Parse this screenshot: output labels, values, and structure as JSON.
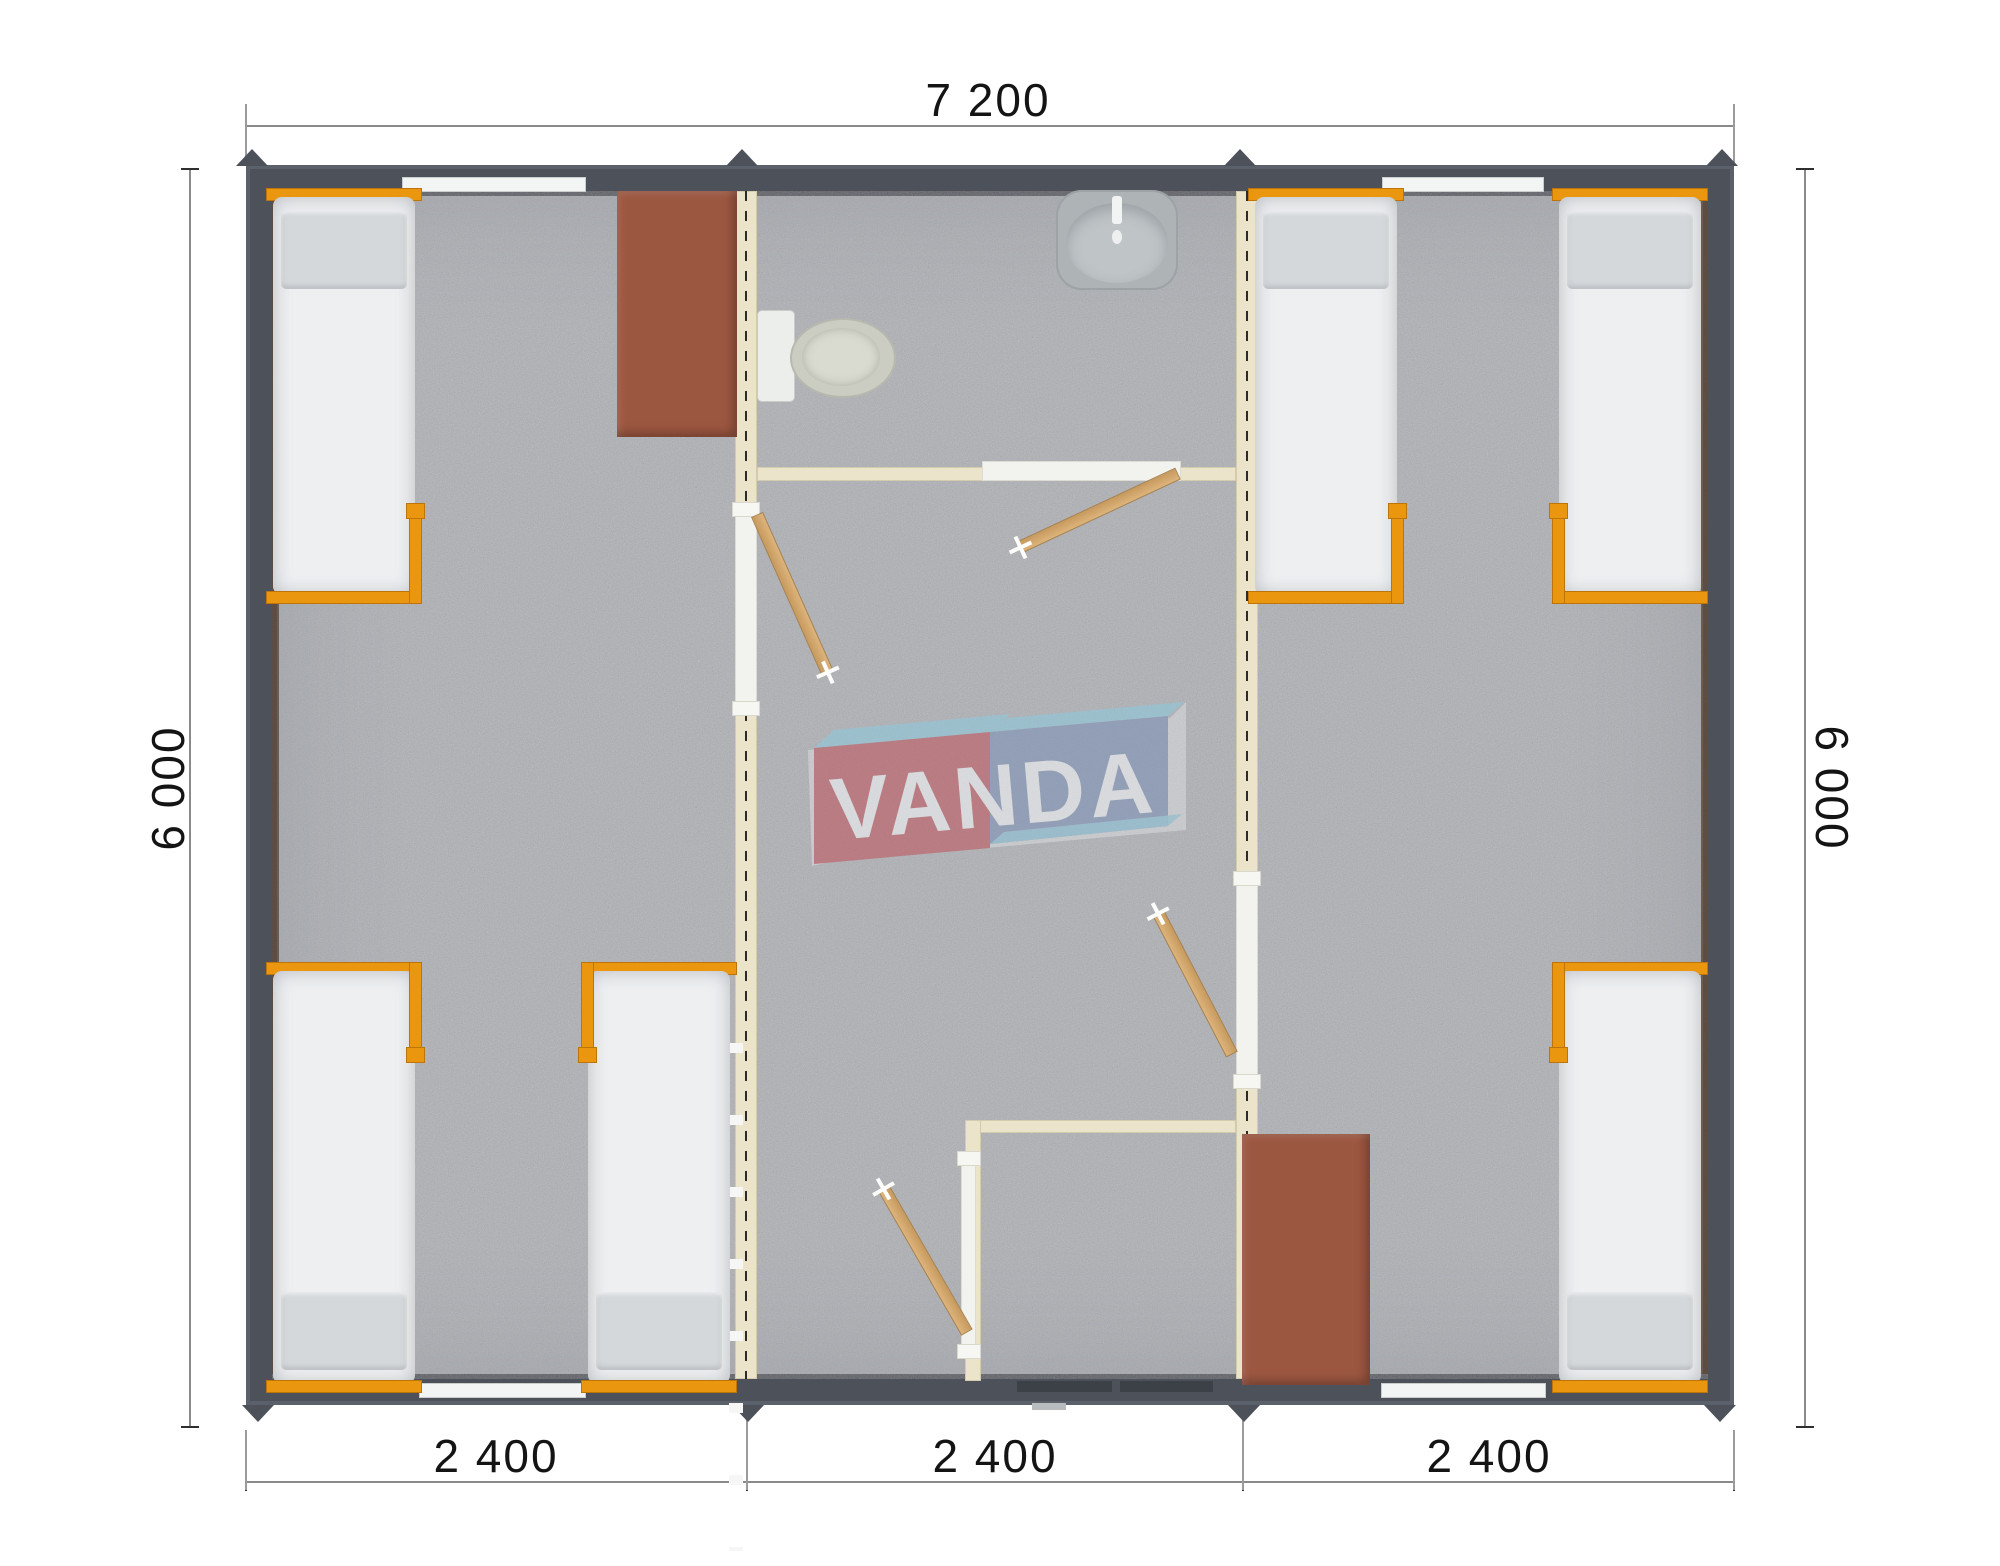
{
  "watermark": {
    "text": "VANDA",
    "colors": {
      "left_box": "#c0565f",
      "right_box": "#7d92b7",
      "top_faces": "#8ec9dd",
      "letters": "#f4f6f8"
    }
  },
  "dimensions": {
    "top": "7 200",
    "left": "6 000",
    "right": "6 000",
    "bottom": [
      "2 400",
      "2 400",
      "2 400"
    ]
  },
  "palette": {
    "outer_wall": "#4c515a",
    "interior_wall": "#ebe3ca",
    "floor_carpet": "#b6b8bb",
    "bed_frame": "#ea960f",
    "mattress": "#edeff1",
    "pillow": "#d4d8db",
    "desk": "#9c5740",
    "door_leaf": "#d2a86e",
    "sanitary_fixture": "#cbcdc3",
    "entrance_door": "#3c4148"
  },
  "modules": {
    "left_bedroom": {
      "beds": 3,
      "desks": 1,
      "windows": 2
    },
    "center_module": {
      "toilets": 1,
      "sinks": 1,
      "showers": 1,
      "entrance_doors": 1,
      "interior_doors": 4
    },
    "right_bedroom": {
      "beds": 3,
      "desks": 1,
      "windows": 2
    }
  }
}
